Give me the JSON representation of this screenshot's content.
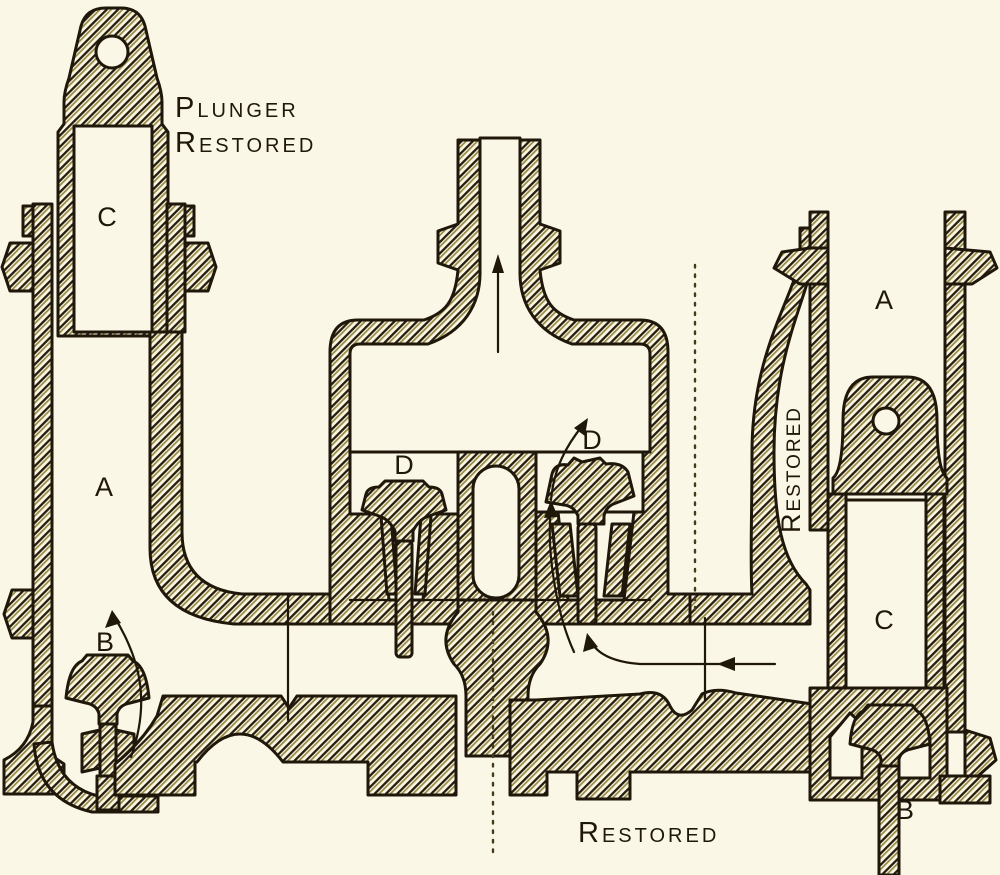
{
  "figure": {
    "palette": {
      "paper": "#fbf7e6",
      "ink": "#1e170a",
      "hatch_dark": "#241b09",
      "hatch_olive": "#968740"
    },
    "captions": {
      "plunger_line1": "Plunger",
      "plunger_line2": "Restored",
      "restored_vertical": "Restored",
      "restored_bottom": "Restored"
    },
    "part_labels": [
      {
        "id": "left-plunger-cavity",
        "text": "C"
      },
      {
        "id": "left-cylinder-bore",
        "text": "A"
      },
      {
        "id": "left-suction-valve",
        "text": "B"
      },
      {
        "id": "left-delivery-valve",
        "text": "D"
      },
      {
        "id": "right-delivery-valve",
        "text": "D"
      },
      {
        "id": "right-cylinder-bore",
        "text": "A"
      },
      {
        "id": "right-plunger-cavity",
        "text": "C"
      },
      {
        "id": "right-suction-valve",
        "text": "B"
      }
    ],
    "annotations": {
      "arrows": [
        "discharge-up-arrow",
        "left-suction-flow-arrow",
        "right-passage-flow-arrow",
        "right-delivery-flow-arrow"
      ],
      "centerlines": [
        "right-pump-centerline-dotted",
        "center-pedestal-centerline-dotted"
      ]
    }
  }
}
